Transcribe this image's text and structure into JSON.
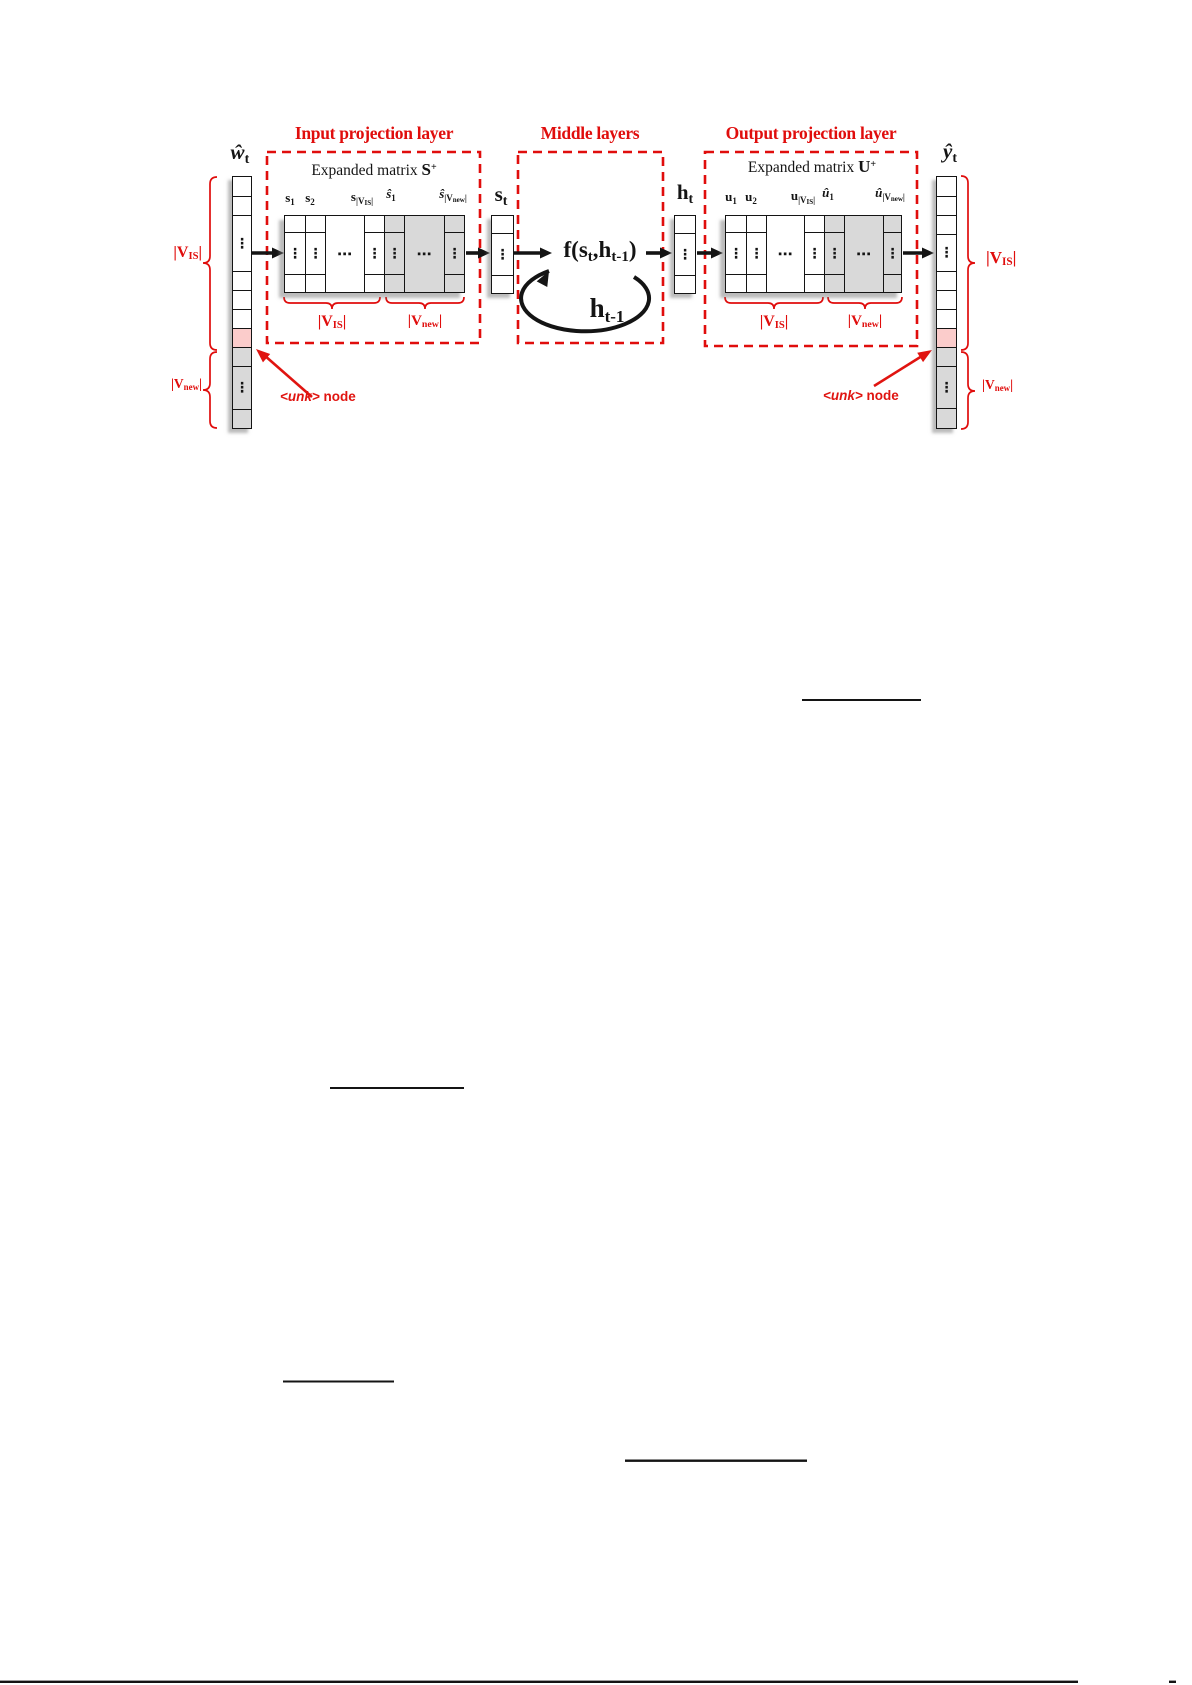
{
  "colors": {
    "red": "#e00d0c",
    "arrow_red": "#e01410",
    "unk_pink": "#fbcccb",
    "new_gray": "#d9d9d9",
    "line_black": "#141414"
  },
  "titles": {
    "input": "Input projection layer",
    "middle": "Middle layers",
    "output": "Output projection layer"
  },
  "expanded_s": {
    "prefix": "Expanded matrix ",
    "symbol": "S",
    "sup": "+"
  },
  "expanded_u": {
    "prefix": "Expanded matrix ",
    "symbol": "U",
    "sup": "+"
  },
  "vector_labels": {
    "w": {
      "base": "ŵ",
      "sub": "t"
    },
    "s": {
      "base": "s",
      "sub": "t"
    },
    "h": {
      "base": "h",
      "sub": "t"
    },
    "y": {
      "base": "ŷ",
      "sub": "t"
    }
  },
  "middle": {
    "function": {
      "pre": "f(s",
      "sub1": "t",
      "mid": ",h",
      "sub2": "t-1",
      "post": ")"
    },
    "recurrent": {
      "base": "h",
      "sub": "t-1"
    }
  },
  "matrix_columns": {
    "s1": {
      "base": "s",
      "sub": "1"
    },
    "s2": {
      "base": "s",
      "sub": "2"
    },
    "s_vis": {
      "base": "s",
      "sub_pre": "|V",
      "sub_sub": "IS",
      "sub_post": "|"
    },
    "s_hat_1": {
      "base": "ŝ",
      "sub": "1"
    },
    "s_hat_vnew": {
      "base": "ŝ",
      "sub_pre": "|V",
      "sub_sub": "new",
      "sub_post": "|"
    },
    "u1": {
      "base": "u",
      "sub": "1"
    },
    "u2": {
      "base": "u",
      "sub": "2"
    },
    "u_vis": {
      "base": "u",
      "sub_pre": "|V",
      "sub_sub": "IS",
      "sub_post": "|"
    },
    "u_hat_1": {
      "base": "û",
      "sub": "1"
    },
    "u_hat_vnew": {
      "base": "û",
      "sub_pre": "|V",
      "sub_sub": "new",
      "sub_post": "|"
    }
  },
  "cardinality": {
    "vis": {
      "pre": "|V",
      "sub": "IS",
      "post": "|"
    },
    "vnew": {
      "pre": "|V",
      "sub": "new",
      "post": "|"
    }
  },
  "annotations": {
    "unk": {
      "tag": "<unk>",
      "rest": " node"
    }
  },
  "dots": {
    "vertical": "⋮",
    "horizontal": "⋯"
  }
}
